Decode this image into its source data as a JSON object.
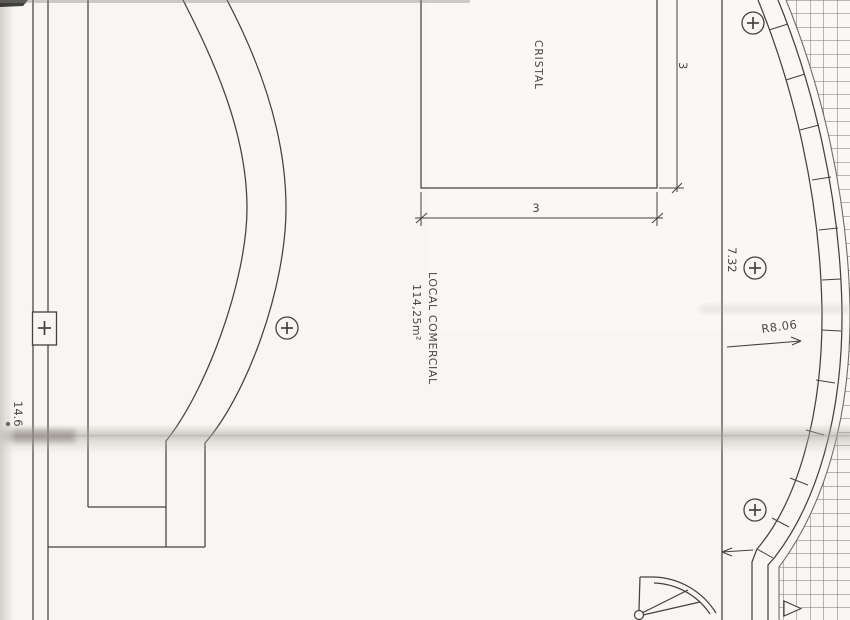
{
  "labels": {
    "glass": "CRISTAL",
    "room_name": "LOCAL COMERCIAL",
    "room_area": "114,25m²"
  },
  "dimensions": {
    "cristal_width": "3",
    "cristal_height": "3",
    "span_right": "7.32",
    "radius_right": "R8.06",
    "height_left": "14.6"
  },
  "symbols": {
    "circle_cross_column_markers": 4,
    "square_cross_column_markers": 1,
    "entrance_triangle_direction": "right",
    "stair_fan": "quarter-circle"
  },
  "colors": {
    "paper": "#f7f6f2",
    "ink": "#44423e",
    "hatch_line": "#75726c",
    "crease": "#b3ada4"
  }
}
